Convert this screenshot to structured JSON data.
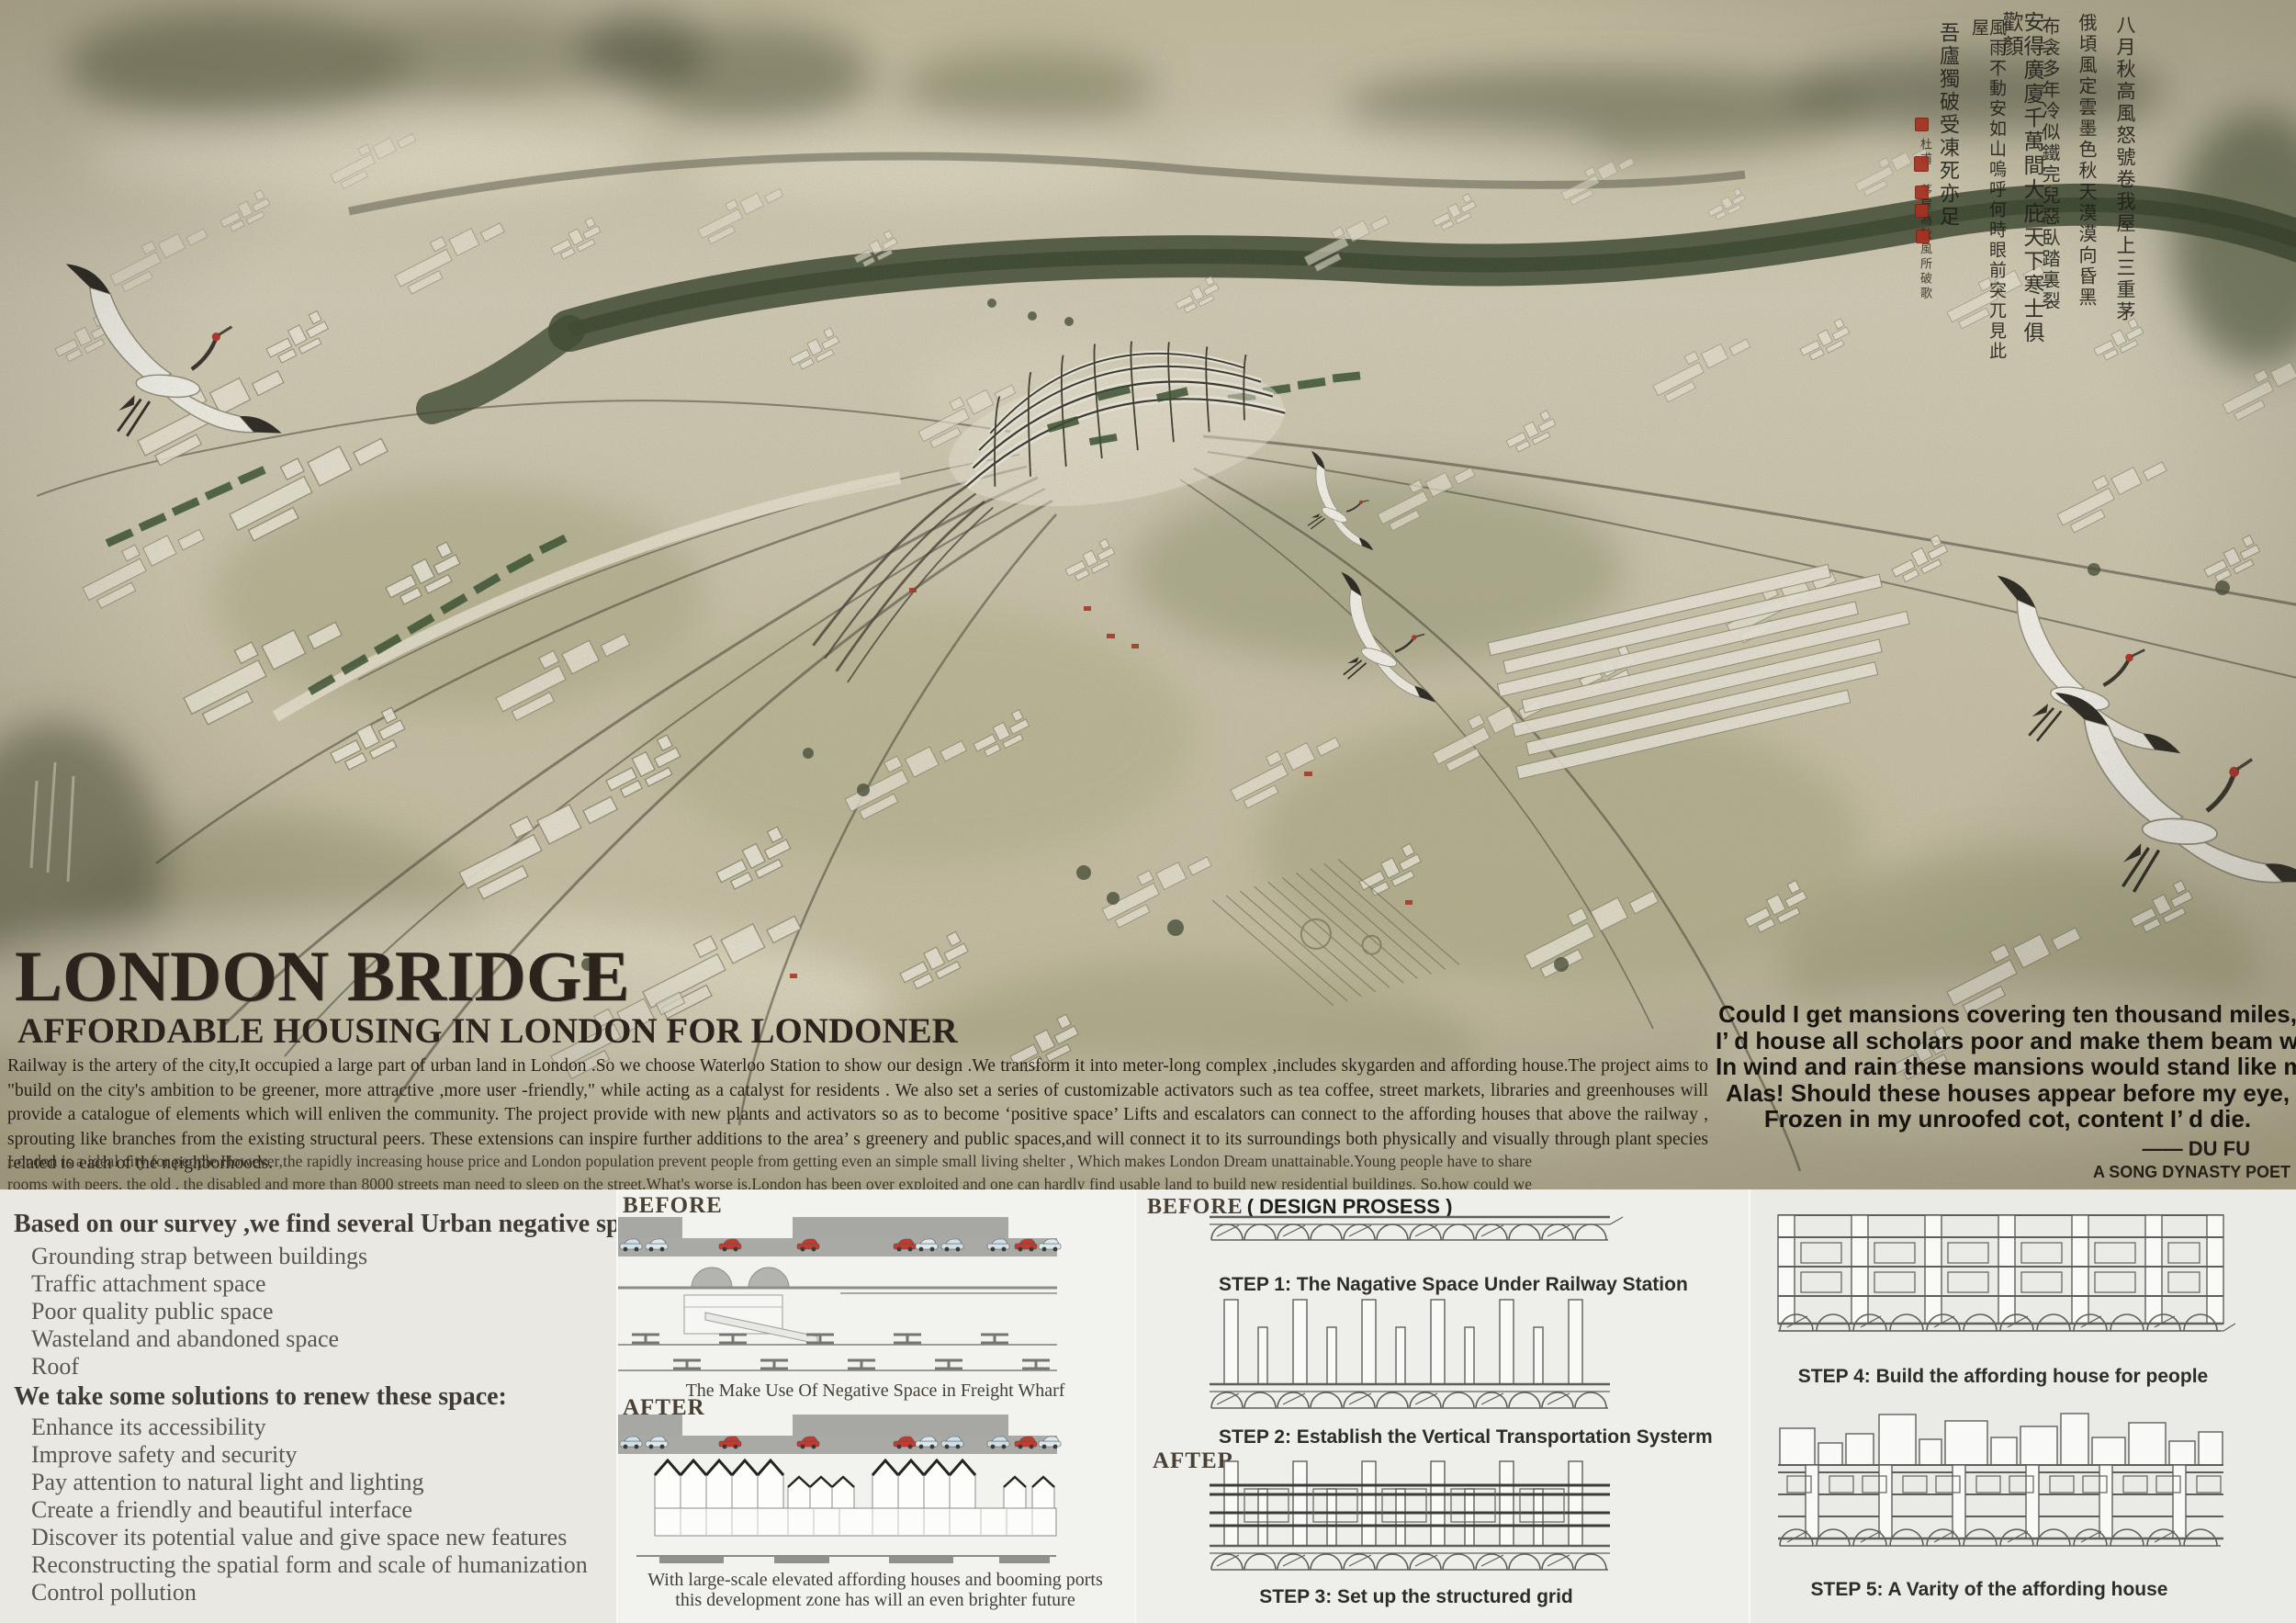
{
  "title": {
    "main": "LONDON BRIDGE",
    "subtitle": "AFFORDABLE HOUSING IN LONDON FOR LONDONER"
  },
  "intro": {
    "para1": "Railway is the artery of the city,It occupied a large part of urban land in London .So we choose Waterloo Station to show our design .We transform   it into meter-long complex ,includes skygarden and affording house.The project aims to \"build on the city's ambition to be greener, more attractive ,more user -friendly,\" while acting as a catalyst for residents . We also set a series of customizable activators such as tea coffee, street markets, libraries and greenhouses will provide a catalogue of elements which will enliven the community. The project provide with new plants and activators so as to become   ‘positive space’  Lifts and escalators can connect to the affording houses that above the railway , sprouting like branches from the  existing structural peers. These extensions can inspire further additions to the area’ s greenery and public spaces,and will connect it to its surroundings both physically and visually through plant species related to each of the neighborhoods.",
    "para2": "London is a ideal city for people.However,the rapidly increasing house price and London population prevent people from getting  even an simple small living shelter , Which makes London Dream unattainable.Young people have to share  rooms with  peers, the old , the disabled and more than 8000 streets man need to sleep on the street.What's worse is,London has been over exploited and one can hardly find usable land to build new residential buildings. So,how could we find  land to build large quantities of affording houses?Therefore ,we find  Urban Negative Space can sovle the problems."
  },
  "poem": {
    "line1": "Could I get mansions covering ten thousand miles,",
    "line2": "I’ d house all scholars poor and make them beam with smiles.",
    "line3": "In wind and rain these mansions would stand like mountains high.",
    "line4": "Alas! Should these houses appear before my eye,",
    "line5": "Frozen in my unroofed cot, content I’ d die.",
    "attribution": "——  DU FU",
    "note": "A SONG DYNASTY POET"
  },
  "calligraphy": {
    "columns": [
      "八月秋高風怒號卷我屋上三重茅",
      "俄頃風定雲墨色秋天漠漠向昏黑",
      "布衾多年冷似鐵完兒惡臥踏裏裂",
      "安得廣廈千萬間大庇天下寒士俱歡顏",
      "風雨不動安如山嗚呼何時眼前突兀見此屋",
      "吾廬獨破受凍死亦足"
    ],
    "signature": "杜甫 茅屋為秋風所破歌"
  },
  "survey": {
    "heading": "Based on our survey ,we find several Urban negative space:",
    "items": [
      "Grounding strap between buildings",
      "Traffic attachment space",
      "Poor quality public space",
      "Wasteland and abandoned space",
      "Roof"
    ]
  },
  "solutions": {
    "heading": "We take some solutions to renew these space:",
    "items": [
      "Enhance its accessibility",
      "Improve safety and security",
      "Pay attention to natural light and lighting",
      "Create a friendly and beautiful interface",
      "Discover its potential value and give space new features",
      "Reconstructing the spatial form and scale of humanization",
      "Control pollution"
    ]
  },
  "wharf": {
    "before_label": "BEFORE",
    "before_caption": "The Make Use Of  Negative Space in Freight Wharf",
    "after_label": "AFTER",
    "after_caption_line1": "With large-scale elevated affording houses and booming ports",
    "after_caption_line2": "this development zone has will an even brighter future"
  },
  "process": {
    "before_label": "BEFORE",
    "note": "( DESIGN PROSESS )",
    "after_label": "AFTER",
    "steps": [
      "STEP 1: The Nagative Space Under Railway Station",
      "STEP 2: Establish the Vertical Transportation Systerm",
      "STEP 3: Set up the structured grid",
      "STEP 4: Build the affording house for people",
      "STEP 5: A Varity of  the affording house"
    ]
  },
  "colors": {
    "paper": "#cfc8b0",
    "ink_olive": "#6a6c50",
    "river_green": "#35422b",
    "train_green": "#2e4a28",
    "building_cream": "#f4f1e4",
    "text_dark": "#2b231c",
    "seal_red": "#a63122",
    "crane_crown_red": "#b5281d"
  }
}
